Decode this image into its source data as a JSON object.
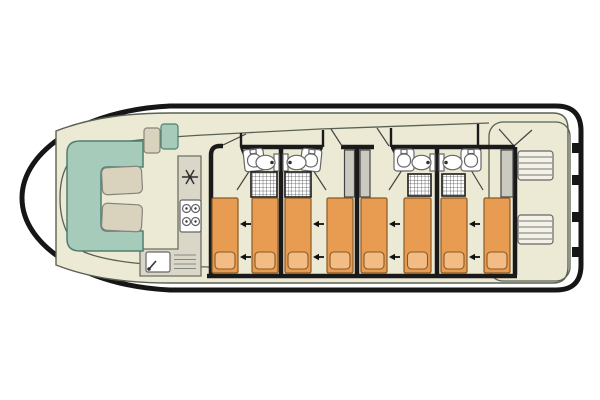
{
  "diagram": {
    "type": "boat-floor-plan",
    "view": "top-down-deck-plan",
    "vessel": "canal-houseboat",
    "orientation": "bow-left-stern-right"
  },
  "colors": {
    "background": "#ffffff",
    "hull_outline": "#161616",
    "walls": "#1a1a1a",
    "deck_fill": "#ECE9D4",
    "deck_outline": "#5A6152",
    "sofa_fill": "#A6CBBA",
    "sofa_outline": "#4F7F70",
    "table_fill": "#D9D3BE",
    "table_outline": "#85857A",
    "counter_fill": "#DAD7C9",
    "counter_outline": "#6F6F66",
    "bed_fill": "#E79C52",
    "bed_outline": "#8A5A24",
    "pillow_fill": "#F2BC84",
    "door_fill": "#CBCAC1",
    "door_outline": "#444444",
    "fixture_fill": "#FFFFFF",
    "fixture_outline": "#666666",
    "stair_fill": "#F4F2E6"
  },
  "components": {
    "bow_saloon": {
      "sofa": "u-shaped-bench",
      "tables": 2,
      "helm_seats": 2
    },
    "galley": {
      "shape": "L-counter",
      "icons": [
        "fridge-snowflake-icon",
        "stove-burners-icon",
        "sink-faucet-icon",
        "drainboard-icon"
      ],
      "burners": 4
    },
    "cabins": {
      "count": 4,
      "beds_per_cabin": 2,
      "total_beds": 8,
      "bed_slide_arrow_direction": "left",
      "arrow_pairs": 4
    },
    "bathrooms": {
      "count": 4,
      "layout": "two-mirrored-pairs",
      "fixtures_each": [
        "washbasin",
        "toilet",
        "shower-grid"
      ]
    },
    "doors": {
      "sliding_doors": 3,
      "swing_door_leaves": 4
    },
    "stern_deck": {
      "stair_flights": 2,
      "mooring_tabs": 4
    }
  }
}
